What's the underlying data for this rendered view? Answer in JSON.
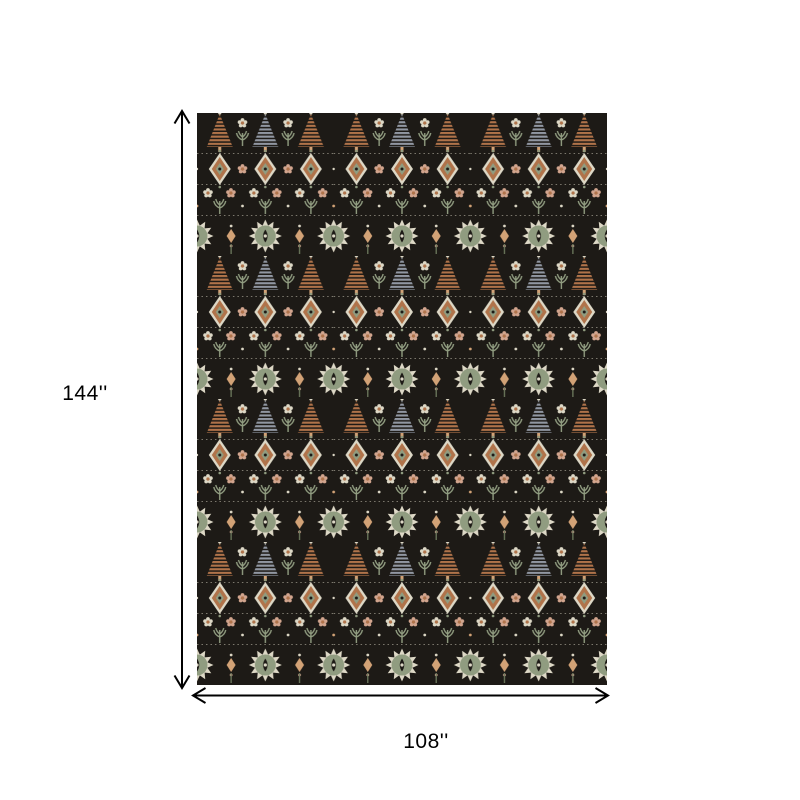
{
  "figure": {
    "title": "Rug dimension diagram",
    "height_label": "144''",
    "width_label": "108''"
  },
  "palette": {
    "background": "#ffffff",
    "line": "#000000",
    "rug_black": "#1d1a16",
    "copper": "#b0734a",
    "copper_light": "#d2a276",
    "cream": "#ddd8c6",
    "blush": "#d2a58e",
    "sage": "#909c80",
    "sage_dark": "#6d7a5e",
    "grey_blue": "#9197a2"
  }
}
